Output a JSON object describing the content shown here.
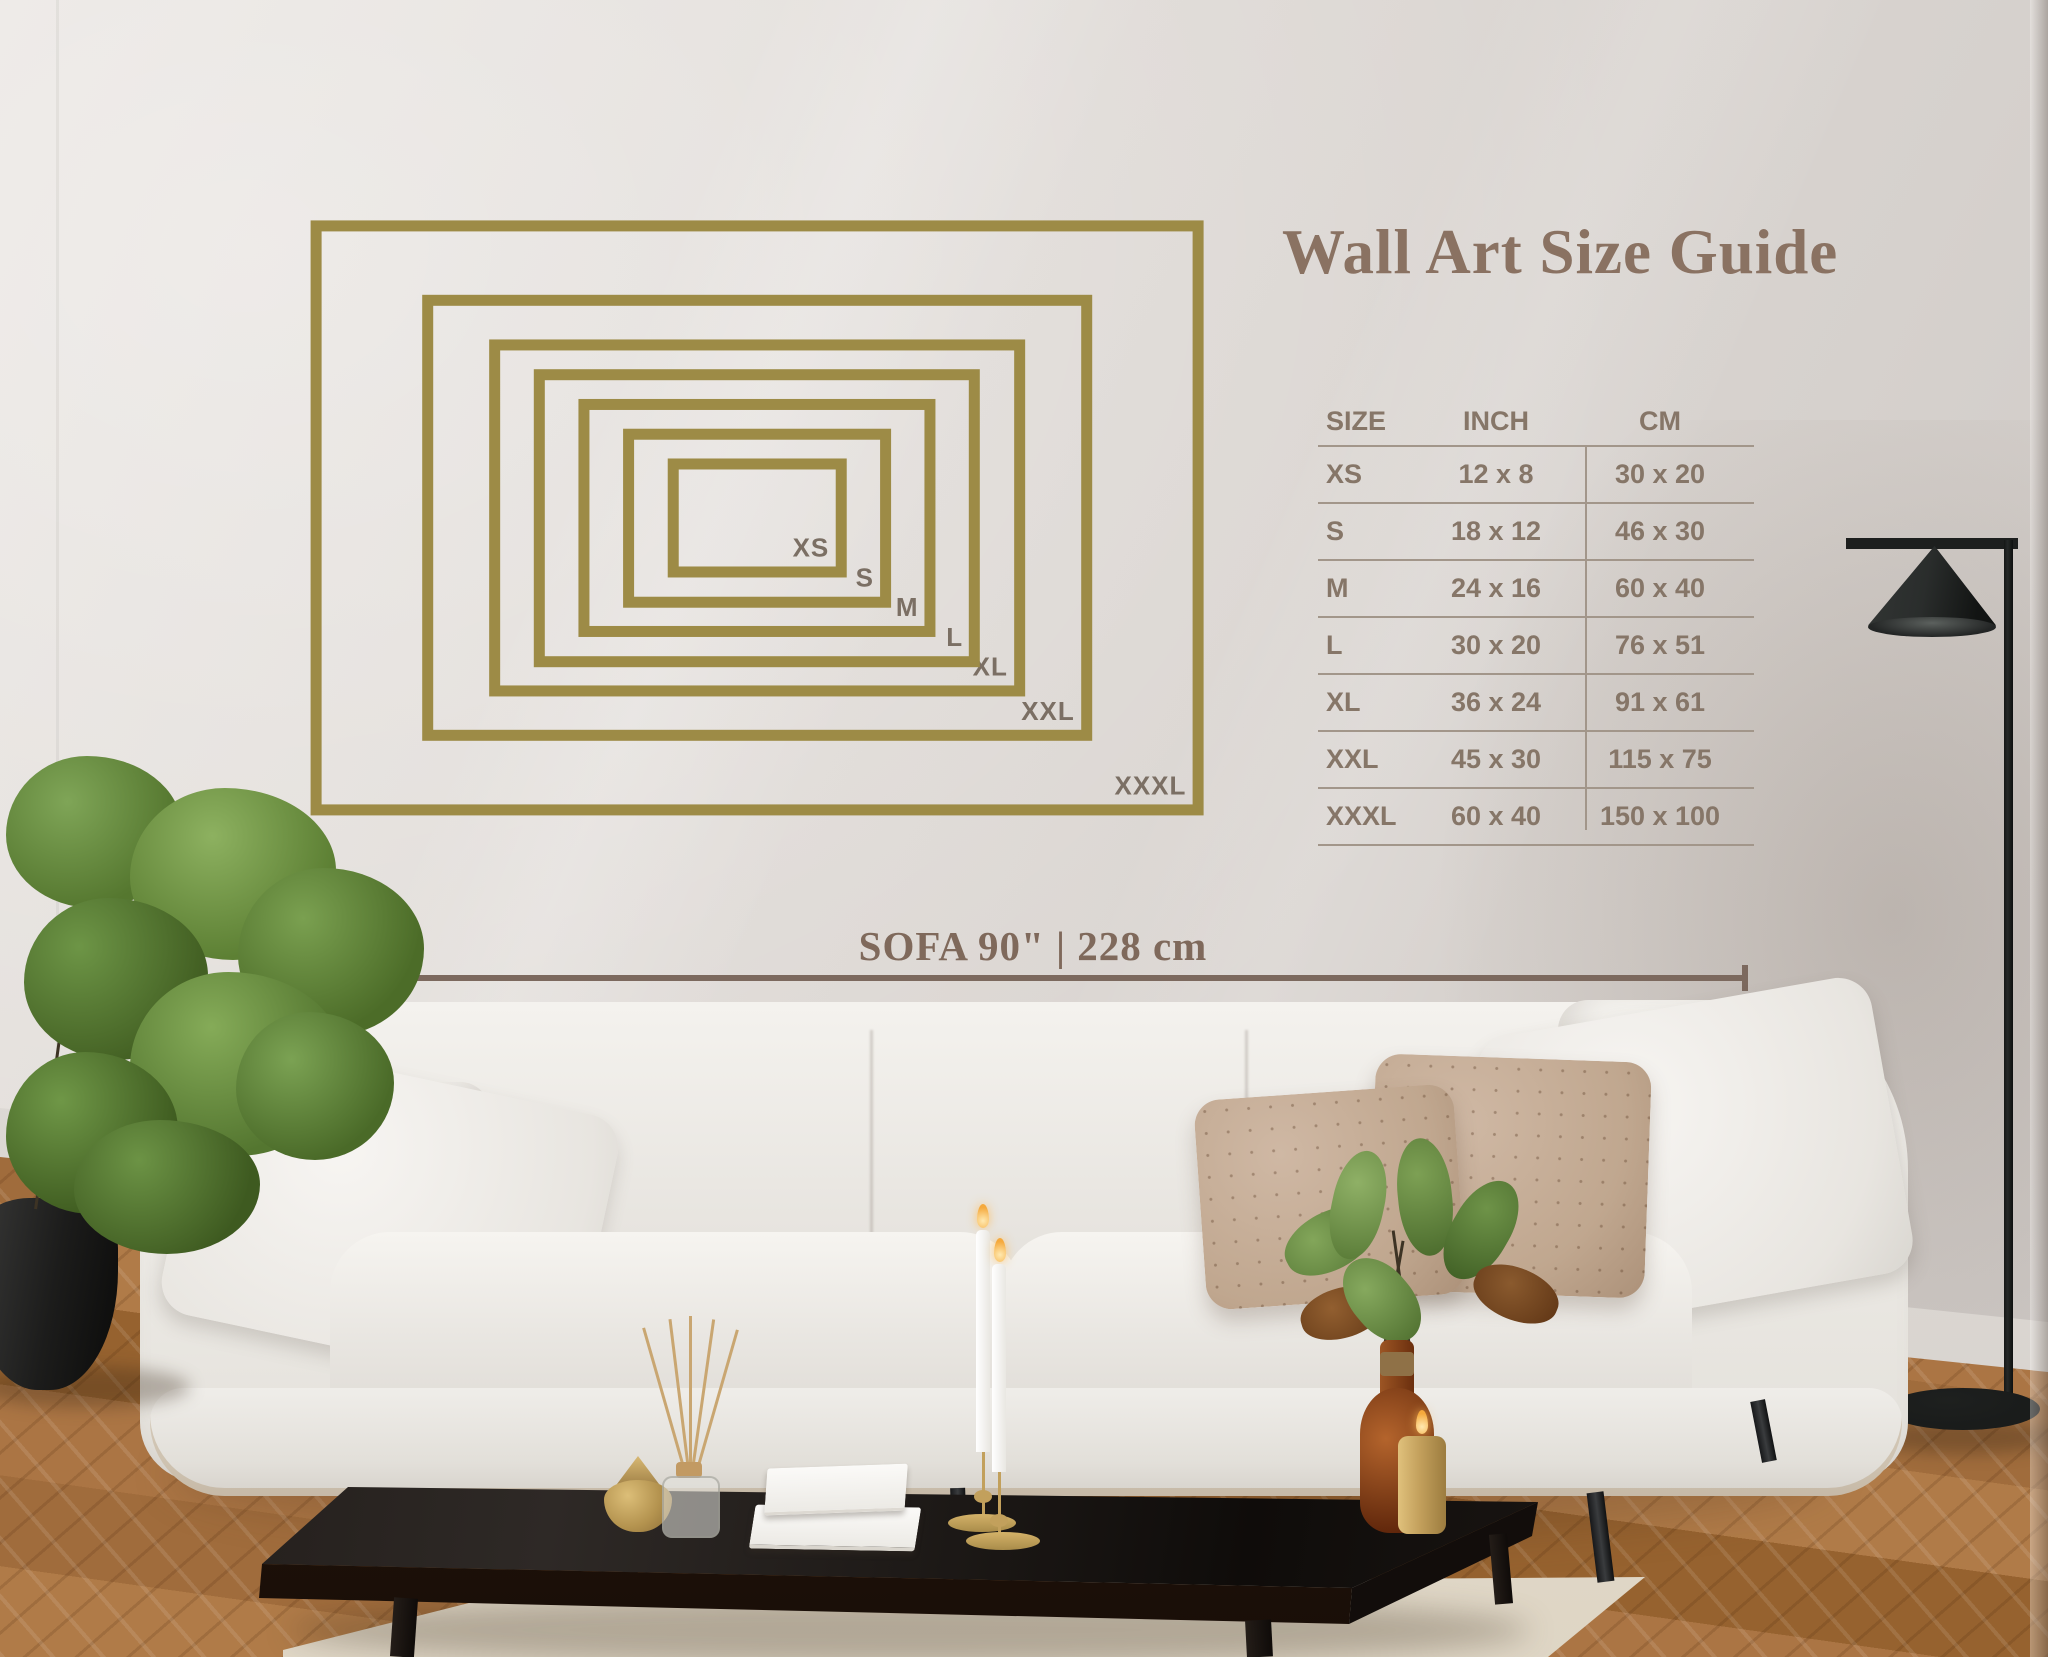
{
  "title": "Wall Art Size Guide",
  "size_table": {
    "headers": [
      "SIZE",
      "INCH",
      "CM"
    ],
    "rows": [
      [
        "XS",
        "12 x 8",
        "30 x 20"
      ],
      [
        "S",
        "18 x 12",
        "46 x 30"
      ],
      [
        "M",
        "24 x 16",
        "60 x 40"
      ],
      [
        "L",
        "30 x 20",
        "76 x 51"
      ],
      [
        "XL",
        "36 x 24",
        "91 x 61"
      ],
      [
        "XXL",
        "45 x 30",
        "115 x 75"
      ],
      [
        "XXXL",
        "60 x 40",
        "150 x 100"
      ]
    ]
  },
  "diagram": {
    "frames": [
      {
        "label": "XS",
        "inch_w": 12,
        "inch_h": 8
      },
      {
        "label": "S",
        "inch_w": 18,
        "inch_h": 12
      },
      {
        "label": "M",
        "inch_w": 24,
        "inch_h": 16
      },
      {
        "label": "L",
        "inch_w": 30,
        "inch_h": 20
      },
      {
        "label": "XL",
        "inch_w": 36,
        "inch_h": 24
      },
      {
        "label": "XXL",
        "inch_w": 45,
        "inch_h": 30
      },
      {
        "label": "XXXL",
        "inch_w": 60,
        "inch_h": 40
      }
    ],
    "frame_color": "#9d8b46",
    "label_color": "#7b6f64"
  },
  "sofa_measure": {
    "text": "SOFA 90\" | 228 cm"
  },
  "accent_colors": {
    "gold": "#9d8b46",
    "title_brown": "#8a7262",
    "table_text": "#867668",
    "measure_brown": "#7c695e"
  }
}
